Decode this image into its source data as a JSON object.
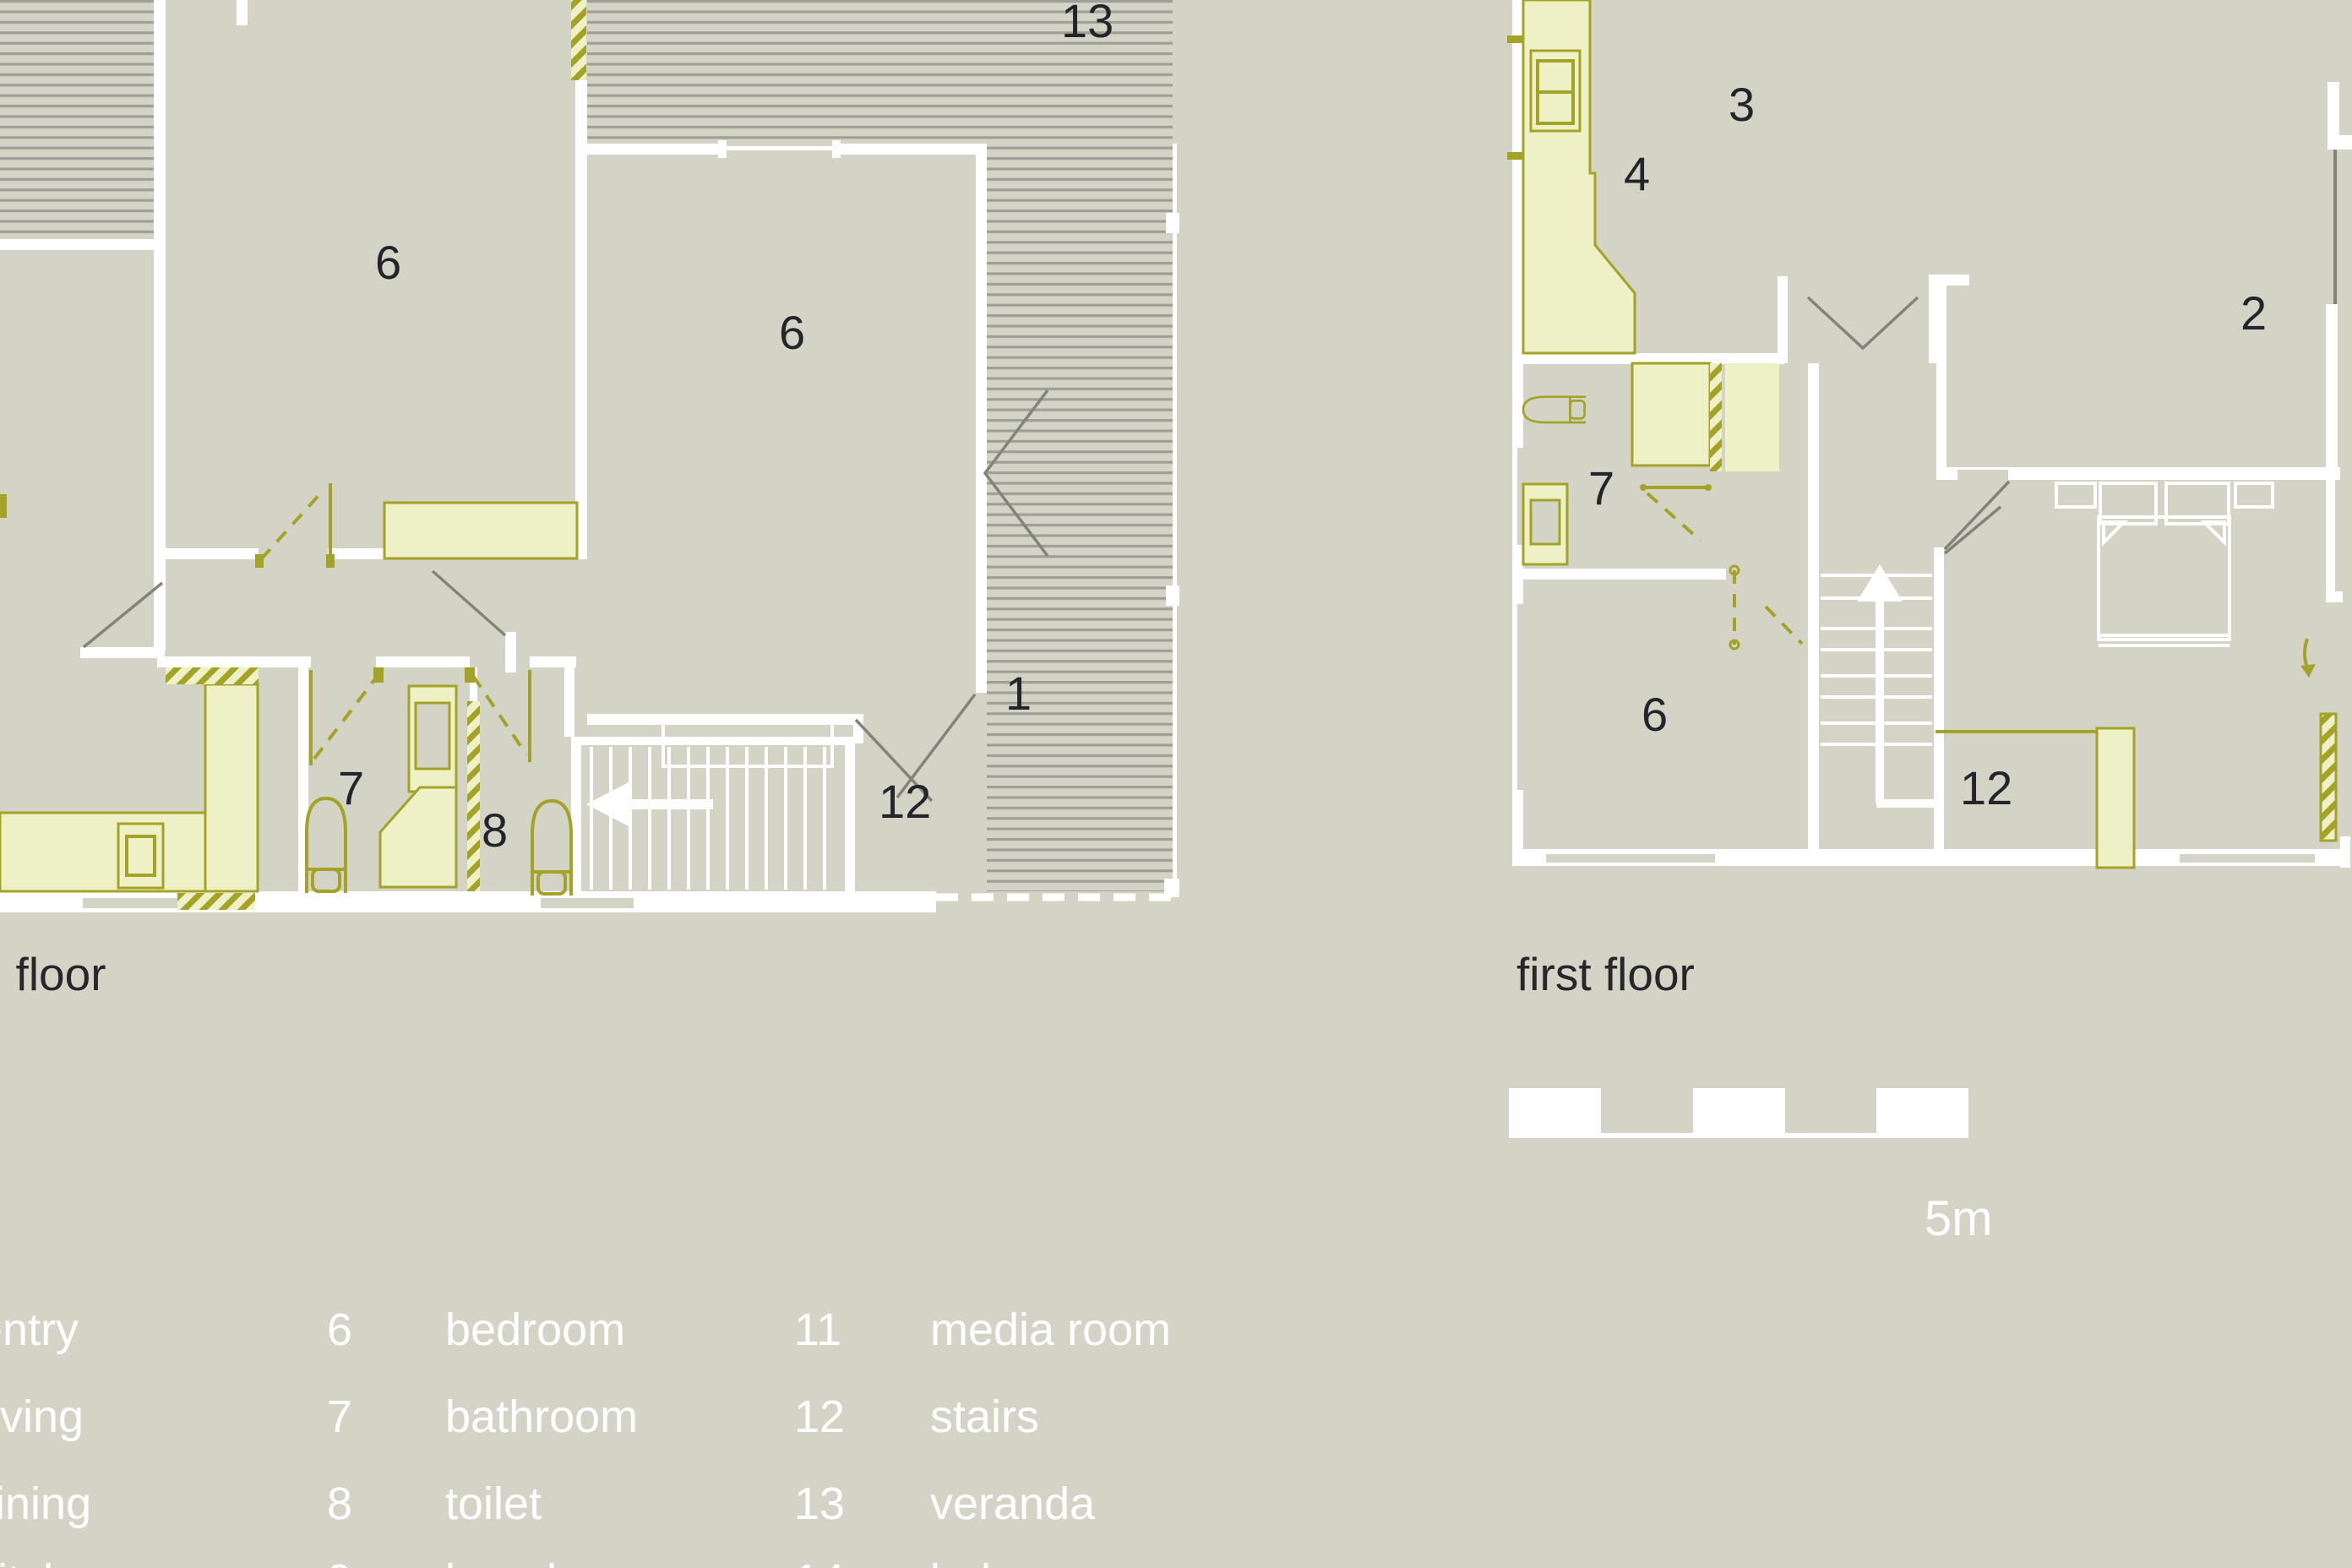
{
  "colors": {
    "background": "#d3d4c6",
    "furniture_fill": "#eef0c6",
    "furniture_line": "#a3a328",
    "wall": "#ffffff",
    "veranda_stripe": "#9fa095",
    "door_swing_line": "#82847a",
    "dark_text": "#23252b",
    "light_text": "#ffffff"
  },
  "plans": {
    "ground": {
      "title": "ground floor",
      "room_labels": {
        "veranda": "13",
        "bedroom_a": "6",
        "bedroom_b": "6",
        "entry": "1",
        "bathroom": "7",
        "toilet": "8",
        "stairs": "12"
      }
    },
    "first": {
      "title": "first floor",
      "room_labels": {
        "dining": "3",
        "kitchen": "4",
        "living": "2",
        "bathroom": "7",
        "bedroom": "6",
        "stairs": "12"
      }
    }
  },
  "scale_bar": {
    "label": "5m",
    "segments": 5
  },
  "legend": {
    "col1": [
      {
        "num": "1",
        "label": "entry"
      },
      {
        "num": "2",
        "label": "living"
      },
      {
        "num": "3",
        "label": "dining"
      },
      {
        "num": "4",
        "label": "kitchen"
      }
    ],
    "col2": [
      {
        "num": "6",
        "label": "bedroom"
      },
      {
        "num": "7",
        "label": "bathroom"
      },
      {
        "num": "8",
        "label": "toilet"
      },
      {
        "num": "9",
        "label": "laundry"
      }
    ],
    "col3": [
      {
        "num": "11",
        "label": "media room"
      },
      {
        "num": "12",
        "label": "stairs"
      },
      {
        "num": "13",
        "label": "veranda"
      },
      {
        "num": "14",
        "label": "balcony"
      }
    ]
  }
}
